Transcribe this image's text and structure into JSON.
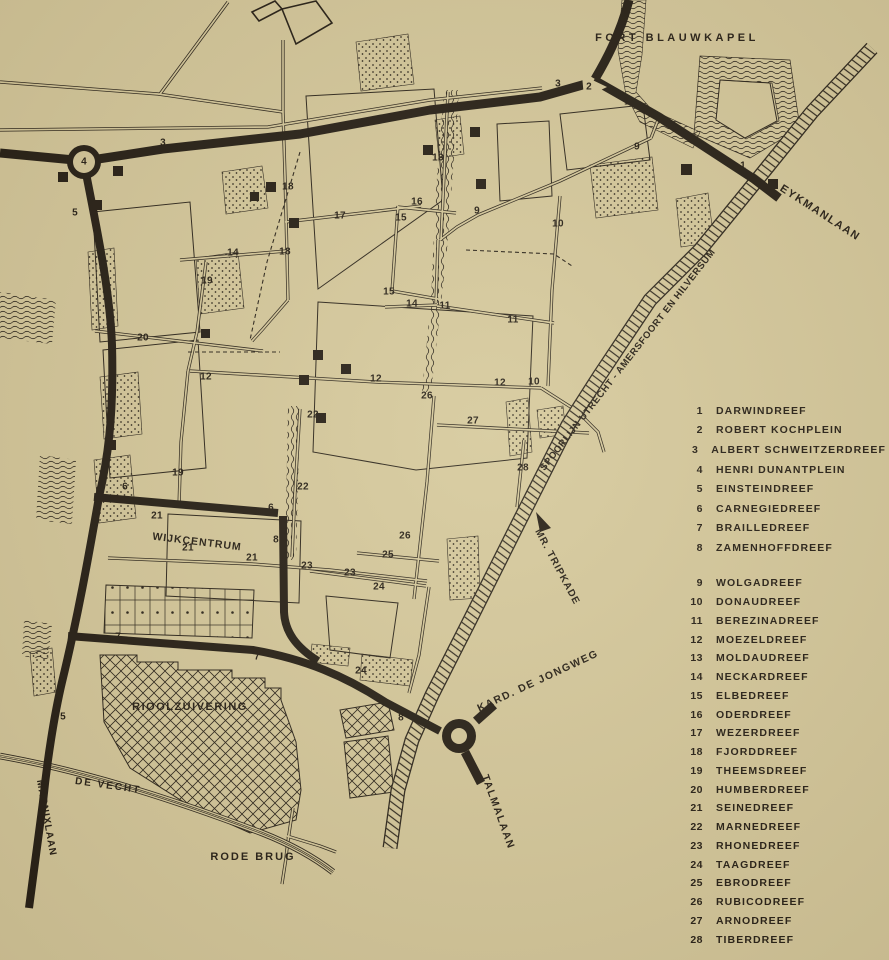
{
  "palette": {
    "paper": "#d5c89b",
    "ink": "#241d14"
  },
  "legend": {
    "group1": [
      {
        "num": "1",
        "name": "DARWINDREEF"
      },
      {
        "num": "2",
        "name": "ROBERT KOCHPLEIN"
      },
      {
        "num": "3",
        "name": "ALBERT SCHWEITZERDREEF"
      },
      {
        "num": "4",
        "name": "HENRI DUNANTPLEIN"
      },
      {
        "num": "5",
        "name": "EINSTEINDREEF"
      },
      {
        "num": "6",
        "name": "CARNEGIEDREEF"
      },
      {
        "num": "7",
        "name": "BRAILLEDREEF"
      },
      {
        "num": "8",
        "name": "ZAMENHOFFDREEF"
      }
    ],
    "group2": [
      {
        "num": "9",
        "name": "WOLGADREEF"
      },
      {
        "num": "10",
        "name": "DONAUDREEF"
      },
      {
        "num": "11",
        "name": "BEREZINADREEF"
      },
      {
        "num": "12",
        "name": "MOEZELDREEF"
      },
      {
        "num": "13",
        "name": "MOLDAUDREEF"
      },
      {
        "num": "14",
        "name": "NECKARDREEF"
      },
      {
        "num": "15",
        "name": "ELBEDREEF"
      },
      {
        "num": "16",
        "name": "ODERDREEF"
      },
      {
        "num": "17",
        "name": "WEZERDREEF"
      },
      {
        "num": "18",
        "name": "FJORDDREEF"
      },
      {
        "num": "19",
        "name": "THEEMSDREEF"
      },
      {
        "num": "20",
        "name": "HUMBERDREEF"
      },
      {
        "num": "21",
        "name": "SEINEDREEF"
      },
      {
        "num": "22",
        "name": "MARNEDREEF"
      },
      {
        "num": "23",
        "name": "RHONEDREEF"
      },
      {
        "num": "24",
        "name": "TAAGDREEF"
      },
      {
        "num": "25",
        "name": "EBRODREEF"
      },
      {
        "num": "26",
        "name": "RUBICODREEF"
      },
      {
        "num": "27",
        "name": "ARNODREEF"
      },
      {
        "num": "28",
        "name": "TIBERDREEF"
      }
    ]
  },
  "map_labels": [
    {
      "id": "fort-blauwkapel",
      "text": "FORT BLAUWKAPEL",
      "x": 677,
      "y": 38,
      "rot": 0,
      "size": 11,
      "ls": 3.5
    },
    {
      "id": "eykmanlaan",
      "text": "EYKMANLAAN",
      "x": 820,
      "y": 213,
      "rot": 33,
      "size": 11,
      "ls": 1.5
    },
    {
      "id": "spoorlijn",
      "text": "SPOORLIJN UTRECHT - AMERSFOORT EN HILVERSUM",
      "x": 628,
      "y": 360,
      "rot": -52,
      "size": 9.5,
      "ls": 0.6
    },
    {
      "id": "mr-tripkade",
      "text": "MR. TRIPKADE",
      "x": 557,
      "y": 567,
      "rot": 62,
      "size": 10,
      "ls": 1
    },
    {
      "id": "kard-de-jongweg",
      "text": "KARD. DE JONGWEG",
      "x": 538,
      "y": 681,
      "rot": -25,
      "size": 10.5,
      "ls": 1.5
    },
    {
      "id": "talmalaan",
      "text": "TALMALAAN",
      "x": 498,
      "y": 812,
      "rot": 70,
      "size": 10.5,
      "ls": 1.5
    },
    {
      "id": "marnixlaan",
      "text": "MARNIXLAAN",
      "x": 46,
      "y": 818,
      "rot": 80,
      "size": 10,
      "ls": 1
    },
    {
      "id": "de-vecht",
      "text": "DE VECHT",
      "x": 108,
      "y": 786,
      "rot": 8,
      "size": 10,
      "ls": 2
    },
    {
      "id": "rode-brug",
      "text": "RODE BRUG",
      "x": 253,
      "y": 857,
      "rot": 0,
      "size": 11,
      "ls": 2
    },
    {
      "id": "rioolzuivering",
      "text": "RIOOLZUIVERING",
      "x": 190,
      "y": 707,
      "rot": 0,
      "size": 11,
      "ls": 1.5
    },
    {
      "id": "wijkcentrum",
      "text": "WIJKCENTRUM",
      "x": 197,
      "y": 542,
      "rot": 7,
      "size": 10.5,
      "ls": 1
    }
  ],
  "map_numbers": [
    {
      "n": "3",
      "x": 163,
      "y": 143
    },
    {
      "n": "4",
      "x": 84,
      "y": 162
    },
    {
      "n": "5",
      "x": 75,
      "y": 213
    },
    {
      "n": "3",
      "x": 558,
      "y": 84
    },
    {
      "n": "2",
      "x": 589,
      "y": 87
    },
    {
      "n": "1",
      "x": 627,
      "y": 102
    },
    {
      "n": "9",
      "x": 637,
      "y": 147
    },
    {
      "n": "1",
      "x": 743,
      "y": 166
    },
    {
      "n": "13",
      "x": 438,
      "y": 158
    },
    {
      "n": "18",
      "x": 288,
      "y": 187
    },
    {
      "n": "16",
      "x": 417,
      "y": 202
    },
    {
      "n": "17",
      "x": 340,
      "y": 216
    },
    {
      "n": "15",
      "x": 401,
      "y": 218
    },
    {
      "n": "9",
      "x": 477,
      "y": 211
    },
    {
      "n": "10",
      "x": 558,
      "y": 224
    },
    {
      "n": "14",
      "x": 233,
      "y": 253
    },
    {
      "n": "18",
      "x": 285,
      "y": 252
    },
    {
      "n": "19",
      "x": 207,
      "y": 281
    },
    {
      "n": "15",
      "x": 389,
      "y": 292
    },
    {
      "n": "14",
      "x": 412,
      "y": 304
    },
    {
      "n": "11",
      "x": 445,
      "y": 306
    },
    {
      "n": "11",
      "x": 513,
      "y": 320
    },
    {
      "n": "20",
      "x": 143,
      "y": 338
    },
    {
      "n": "12",
      "x": 206,
      "y": 377
    },
    {
      "n": "12",
      "x": 376,
      "y": 379
    },
    {
      "n": "12",
      "x": 500,
      "y": 383
    },
    {
      "n": "10",
      "x": 534,
      "y": 382
    },
    {
      "n": "26",
      "x": 427,
      "y": 396
    },
    {
      "n": "22",
      "x": 313,
      "y": 415
    },
    {
      "n": "27",
      "x": 473,
      "y": 421
    },
    {
      "n": "28",
      "x": 523,
      "y": 468
    },
    {
      "n": "19",
      "x": 178,
      "y": 473
    },
    {
      "n": "6",
      "x": 125,
      "y": 487
    },
    {
      "n": "22",
      "x": 303,
      "y": 487
    },
    {
      "n": "6",
      "x": 271,
      "y": 508
    },
    {
      "n": "21",
      "x": 157,
      "y": 516
    },
    {
      "n": "8",
      "x": 276,
      "y": 540
    },
    {
      "n": "21",
      "x": 188,
      "y": 548
    },
    {
      "n": "26",
      "x": 405,
      "y": 536
    },
    {
      "n": "25",
      "x": 388,
      "y": 555
    },
    {
      "n": "21",
      "x": 252,
      "y": 558
    },
    {
      "n": "23",
      "x": 307,
      "y": 566
    },
    {
      "n": "23",
      "x": 350,
      "y": 573
    },
    {
      "n": "24",
      "x": 379,
      "y": 587
    },
    {
      "n": "7",
      "x": 118,
      "y": 637
    },
    {
      "n": "7",
      "x": 257,
      "y": 657
    },
    {
      "n": "24",
      "x": 361,
      "y": 671
    },
    {
      "n": "5",
      "x": 63,
      "y": 717
    },
    {
      "n": "8",
      "x": 401,
      "y": 718
    }
  ]
}
